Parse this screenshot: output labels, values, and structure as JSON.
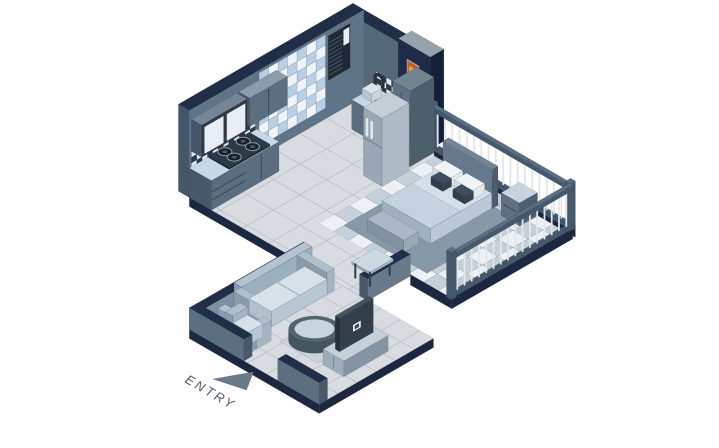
{
  "labels": {
    "entry": "ENTRY"
  },
  "palette": {
    "background": "#ffffff",
    "wall_left": "#5f7486",
    "wall_right": "#546878",
    "wall_top": "#202e48",
    "wall_end": "#44566a",
    "navy_wall": "#1e2b49",
    "navy_wall_end": "#141f38",
    "navy_wall_top": "#95a2ae",
    "fascia": "#1b2840",
    "floor": "#d8dce0",
    "floor_line": "#bfc5cc",
    "checker_light": "#edf1f5",
    "checker_dark": "#c6d0d9",
    "glass_blue": "#b9d0e4",
    "glass_white": "#eef4f8",
    "splash_dark": "#2e3947",
    "splash_light": "#dfe6ec",
    "counter_top": "#c6d9e8",
    "cabinet_front": "#5a6d7e",
    "cabinet_side": "#475868",
    "stove": "#2c3946",
    "burner": "#18212c",
    "steel": "#28323e",
    "fridge_front": "#97a7b4",
    "fridge_side": "#aebbc6",
    "fridge_top": "#c3cfd7",
    "ac_panel": "#1f2936",
    "ac_grille": "#4a5663",
    "ac_door": "#e9eef2",
    "painting_frame": "#c2cbd3",
    "painting_orange": "#c95f1e",
    "painting_dark": "#59260f",
    "painting_gold": "#e8a33c",
    "rail_dark": "#45586c",
    "rail_top": "#5a6e80",
    "baluster": "#e2e7ea",
    "rug": "#8798a6",
    "headboard": "#66788b",
    "mattress": "#d4dfe9",
    "pillow": "#f1f4f7",
    "cushion": "#3e4d5f",
    "sofa_light": "#b3c3cf",
    "sofa_mid": "#9db0bd",
    "sofa_deep": "#8a9cab",
    "sofa_cushion": "#d6e1ea",
    "tv_dark": "#323e49",
    "tv_screen_dot": "#f2f5f7",
    "stand": "#c4d1da",
    "low_wall_inner": "#7e91a2",
    "low_wall_outer": "#5c6f80",
    "low_wall_end": "#47596b",
    "entry_text": "#4d5c6b",
    "entry_arrow": "#6b7a89"
  }
}
